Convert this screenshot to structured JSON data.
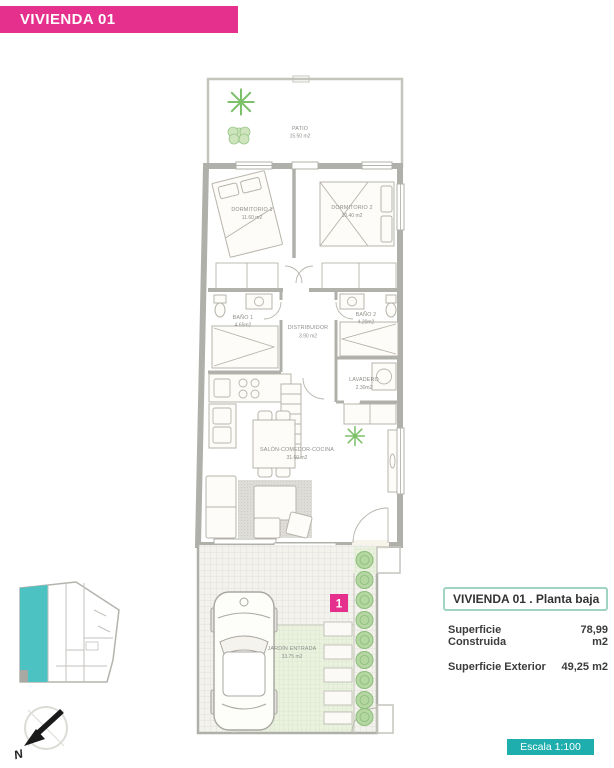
{
  "colors": {
    "pink": "#e5308d",
    "teal": "#1faeae",
    "site_teal": "#4cc2c2",
    "info_border": "#9fd3c3",
    "wall": "#b0b0ab"
  },
  "banner": {
    "title": "VIVIENDA 01"
  },
  "floor_plan": {
    "rooms": {
      "patio": {
        "name": "PATIO",
        "area": "15.50 m2"
      },
      "dormitorio_1": {
        "name": "DORMITORIO 1",
        "area": "11.60 m2"
      },
      "dormitorio_2": {
        "name": "DORMITORIO 2",
        "area": "10.40 m2"
      },
      "bano_1": {
        "name": "BAÑO 1",
        "area": "4.65m2"
      },
      "distribuidor": {
        "name": "DISTRIBUIDOR",
        "area": "3.90 m2"
      },
      "bano_2": {
        "name": "BAÑO 2",
        "area": "4.20m2"
      },
      "lavadero": {
        "name": "LAVADERO",
        "area": "2.30m2"
      },
      "salon": {
        "name": "SALÓN-COMEDOR-COCINA",
        "area": "31.60 m2"
      },
      "jardin": {
        "name": "JARDÍN ENTRADA",
        "area": "33.75 m2"
      }
    },
    "unit_marker": "1",
    "compass_label": "N"
  },
  "info_panel": {
    "title": "VIVIENDA 01 .  Planta baja",
    "rows": [
      {
        "label": "Superficie Construida",
        "value": "78,99 m2"
      },
      {
        "label": "Superficie Exterior",
        "value": "49,25 m2"
      }
    ]
  },
  "scale_badge": "Escala 1:100"
}
